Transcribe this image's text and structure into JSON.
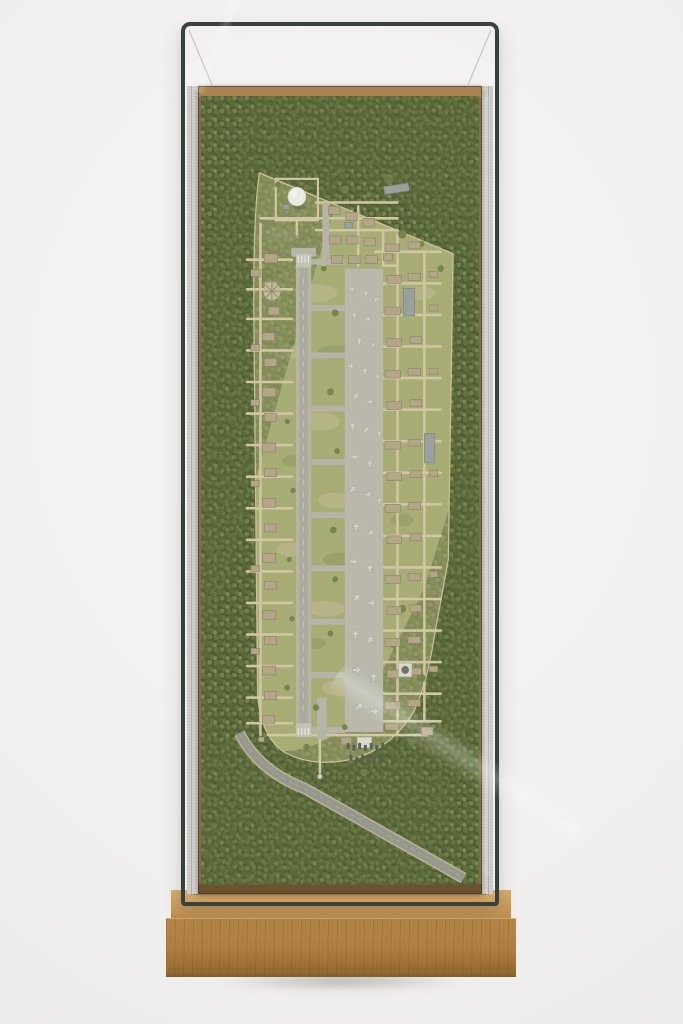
{
  "scene": {
    "subject": "Photograph of a wall-mounted glass display case containing an aerial scale-model diorama of a forested airbase with runway, apron of parked aircraft, barracks districts, a white radome and an access road, set on an oak plinth",
    "elements": [
      "glass-vitrine",
      "felt-lining",
      "wood-frame",
      "forest",
      "airfield-clearing",
      "runway",
      "taxiway-apron",
      "parked-aircraft",
      "radar-dome",
      "barracks",
      "dirt-roads",
      "perimeter-track",
      "access-road",
      "motor-pool",
      "oak-plinth"
    ]
  },
  "colors": {
    "wall": "#f1f0ee",
    "wall_edge": "#dfdedc",
    "glass_frame": "#39413d",
    "glass_line": "#c9c9c5",
    "felt": "#d6d4d0",
    "wood_frame": "#8a6a42",
    "forest_base": "#45532c",
    "forest_dark": "#51612f",
    "forest_mid": "#5c6c38",
    "forest_light": "#6d7d45",
    "forest_pale": "#77874c",
    "grass": "#a9ad74",
    "grass_light": "#c6c09a",
    "grass_dark": "#7a8350",
    "dirt_road": "#d8cca8",
    "track": "#cfc49e",
    "pavement": "#b9b7ac",
    "pavement_light": "#c8c6bb",
    "pavement_dark": "#a3a196",
    "apron": "#bdbbb1",
    "aircraft": "#d9d8d2",
    "aircraft_outline": "#90908a",
    "vehicle": "#54574f",
    "building_tan": "#b6a788",
    "building_edge": "#7c7463",
    "building_gray": "#9aa0a0",
    "white_roof": "#e2e0da",
    "radome": "#f4f3ef",
    "road_gray": "#97968f",
    "road_verge": "#b9b294",
    "oak_top": "#d3a768",
    "oak_front": "#b08144",
    "oak_dark": "#7e5c2e"
  }
}
